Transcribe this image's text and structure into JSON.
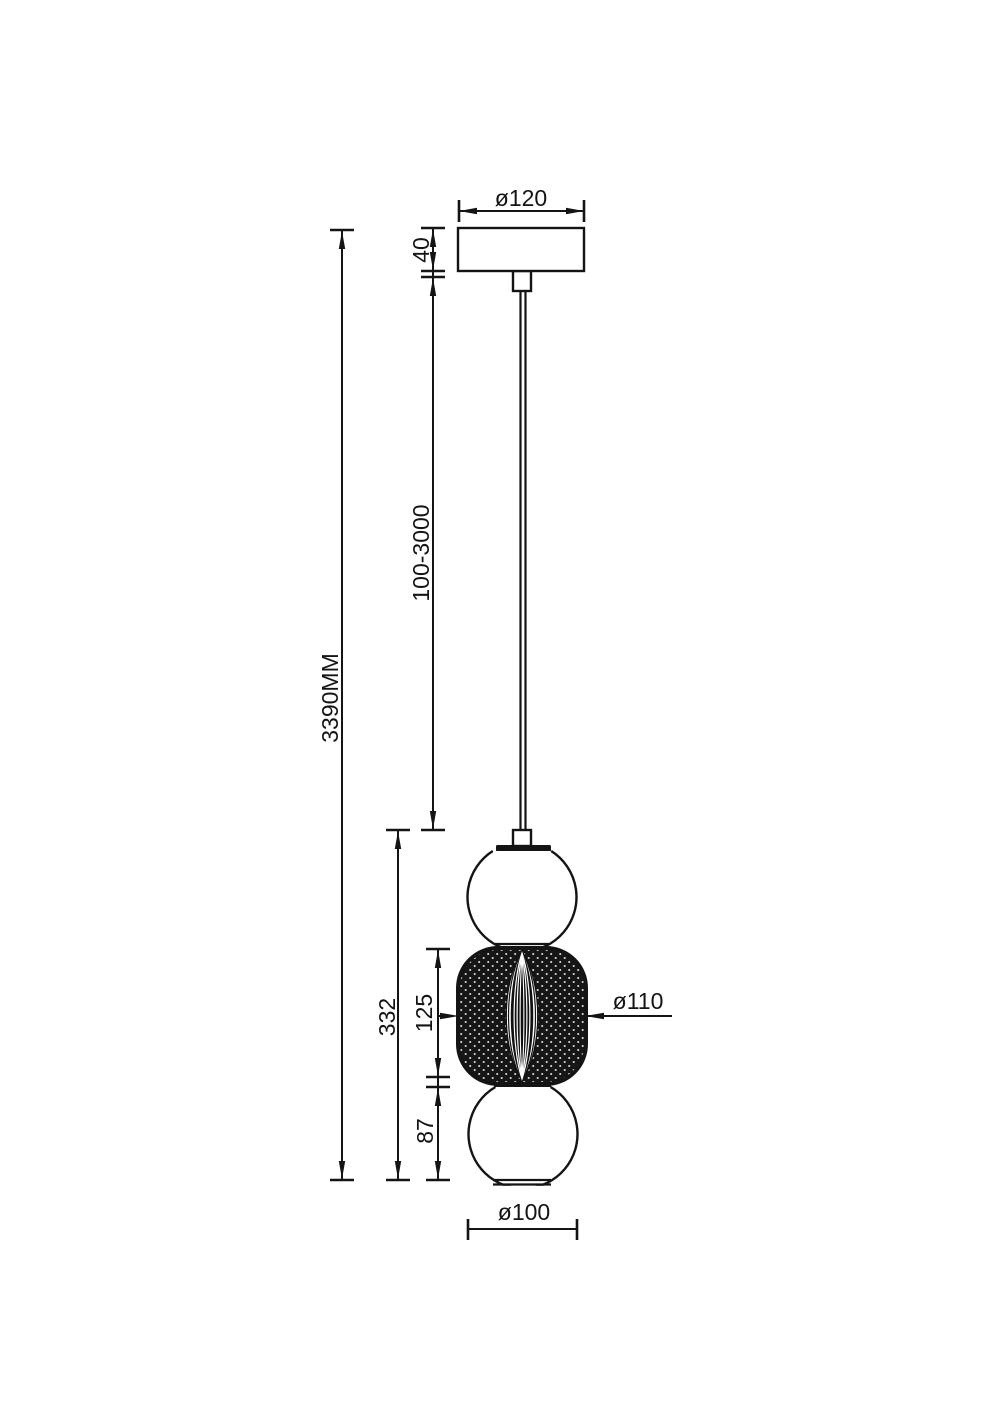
{
  "drawing": {
    "kind": "pendant-lamp-dimension-drawing",
    "labels": {
      "canopy_diameter": "ø120",
      "canopy_height": "40",
      "suspension_length": "100-3000",
      "total_height": "3390MM",
      "body_height": "332",
      "diffuser_height": "125",
      "bottom_sphere_height": "87",
      "diffuser_diameter": "ø110",
      "sphere_diameter": "ø100"
    },
    "colors": {
      "line": "#141414",
      "background": "#ffffff"
    }
  }
}
